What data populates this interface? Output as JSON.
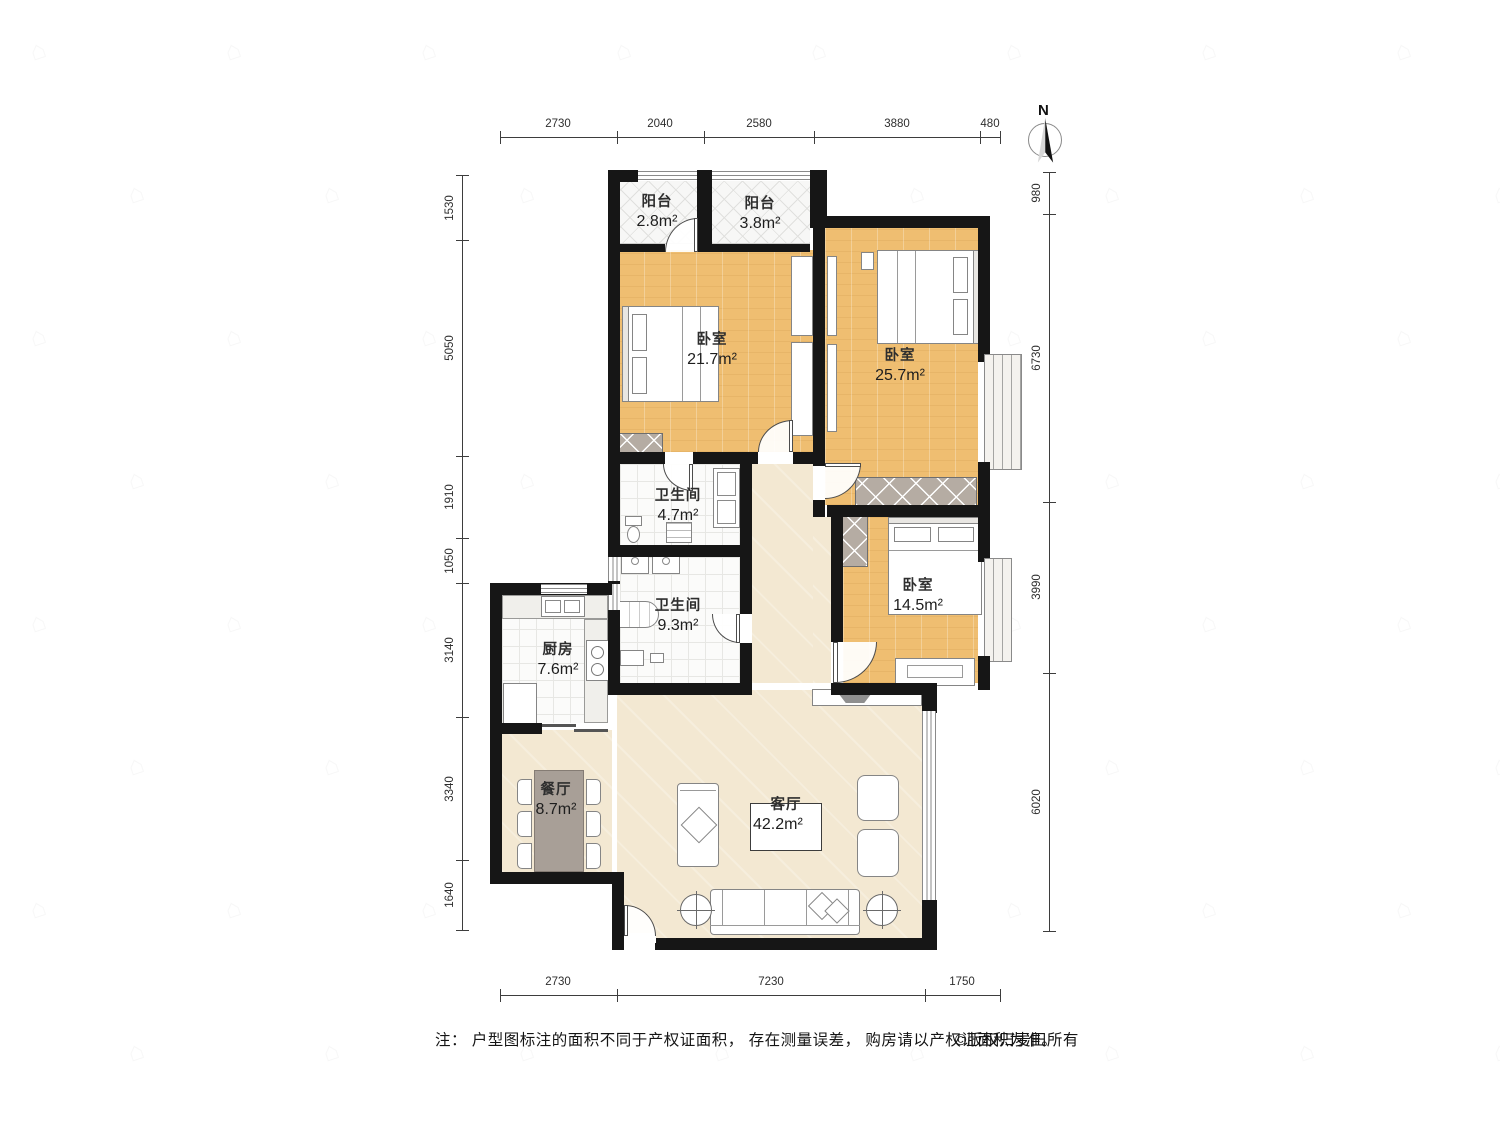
{
  "watermark_glyph": "⌂",
  "compass": {
    "north_label": "N"
  },
  "rooms": {
    "balcony1": {
      "name": "阳台",
      "area": "2.8m²"
    },
    "balcony2": {
      "name": "阳台",
      "area": "3.8m²"
    },
    "bedroom_a": {
      "name": "卧室",
      "area": "21.7m²"
    },
    "bedroom_b": {
      "name": "卧室",
      "area": "25.7m²"
    },
    "bedroom_c": {
      "name": "卧室",
      "area": "14.5m²"
    },
    "bath_a": {
      "name": "卫生间",
      "area": "4.7m²"
    },
    "bath_b": {
      "name": "卫生间",
      "area": "9.3m²"
    },
    "kitchen": {
      "name": "厨房",
      "area": "7.6m²"
    },
    "dining": {
      "name": "餐厅",
      "area": "8.7m²"
    },
    "living": {
      "name": "客厅",
      "area": "42.2m²"
    }
  },
  "dims": {
    "top": [
      "2730",
      "2040",
      "2580",
      "3880",
      "480"
    ],
    "bottom": [
      "2730",
      "7230",
      "1750"
    ],
    "left": [
      "1530",
      "5050",
      "1910",
      "1050",
      "3140",
      "3340",
      "1640"
    ],
    "right": [
      "980",
      "6730",
      "3990",
      "6020"
    ]
  },
  "footer": {
    "note": "注： 户型图标注的面积不同于产权证面积， 存在测量误差， 购房请以产权证面积为准。",
    "copyright": "©版权归麦田所有"
  },
  "colors": {
    "wall": "#161616",
    "bedroom_floor": "#efbe71",
    "public_floor": "#f3e8d2",
    "wardrobe": "#b5aca3",
    "dining_table": "#a89f97"
  }
}
